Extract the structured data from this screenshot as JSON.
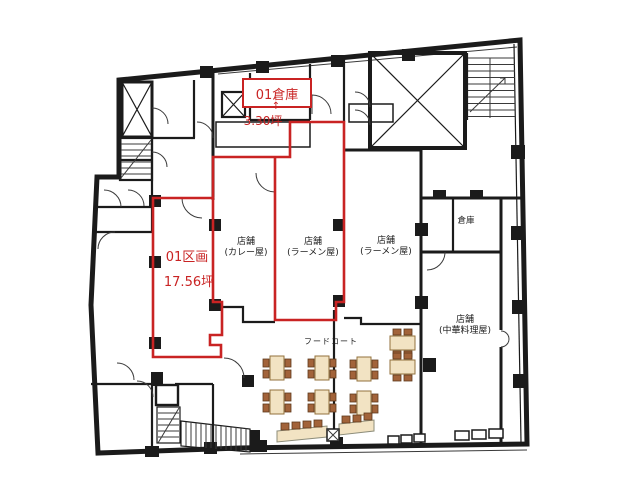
{
  "floor_plan": {
    "colors": {
      "highlight": "#c92323",
      "wall": "#1b1b1b",
      "table_fill": "#f2e3c3",
      "table_border": "#93713d",
      "chair": "#a2633a"
    },
    "units": {
      "storage": {
        "label": "01倉庫",
        "arrow": "↑",
        "area": "3.30坪"
      },
      "section": {
        "label": "01区画",
        "area": "17.56坪"
      }
    },
    "shops": {
      "curry": {
        "name": "店舗",
        "type": "(カレー屋)"
      },
      "ramen_center": {
        "name": "店舗",
        "type": "(ラーメン屋)"
      },
      "ramen_right": {
        "name": "店舗",
        "type": "(ラーメン屋)"
      },
      "chinese": {
        "name": "店舗",
        "type": "(中華料理屋)"
      },
      "storage_room": {
        "name": "倉庫"
      },
      "food_court": {
        "name": "フードコート"
      }
    }
  }
}
